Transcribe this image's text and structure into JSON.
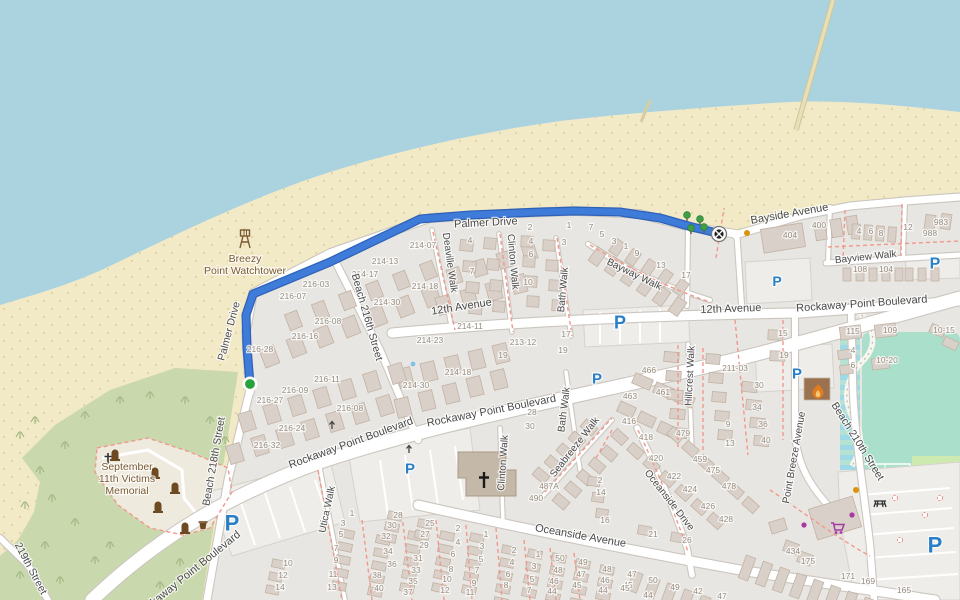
{
  "map": {
    "colors": {
      "water": "#aad3df",
      "sand": "#f2e9c6",
      "sand_speckle": "#dbcd99",
      "land": "#e8e6e2",
      "lot": "#efedea",
      "scrub": "#c9d8ad",
      "scrub_mark": "#a3b883",
      "memorial_ground": "#efeade",
      "grass": "#cdebb0",
      "pitch": "#aae0cb",
      "building": "#d9d0c9",
      "building_stroke": "#c2b3a3",
      "church": "#c4b8a8",
      "fire_building": "#9b7250",
      "road": "#ffffff",
      "road_casing": "#cbc6bf",
      "route": "#3f7bd9",
      "route_casing": "#2d62b8",
      "start_marker": "#28a33c",
      "parking_blue": "#2a7fc9",
      "street_label": "#4a4a4a",
      "house_number": "#978d7f",
      "poi_brown": "#7a5b33",
      "dashed_pink": "#f2988c",
      "tree_green": "#3f9e46",
      "shop_purple": "#a639a6",
      "flame_orange": "#e07b1f"
    },
    "route": {
      "points": [
        [
          250,
          384
        ],
        [
          247,
          348
        ],
        [
          246,
          315
        ],
        [
          253,
          294
        ],
        [
          330,
          262
        ],
        [
          420,
          219
        ],
        [
          470,
          215
        ],
        [
          540,
          212
        ],
        [
          575,
          211
        ],
        [
          620,
          212
        ],
        [
          660,
          218
        ],
        [
          692,
          227
        ],
        [
          717,
          233
        ]
      ]
    },
    "markers": {
      "start": {
        "x": 250,
        "y": 384
      },
      "end": {
        "x": 719,
        "y": 234
      }
    },
    "poi_labels": [
      {
        "name": "breezy-point-watchtower",
        "lines": [
          "Breezy",
          "Point Watchtower"
        ],
        "x": 245,
        "y": 262
      },
      {
        "name": "september-11th-victims-memorial",
        "lines": [
          "September",
          "11th Victims",
          "Memorial"
        ],
        "x": 127,
        "y": 470
      }
    ],
    "street_labels": [
      {
        "text": "Palmer Drive",
        "x": 232,
        "y": 332,
        "rot": -75,
        "size": 10.5
      },
      {
        "text": "Palmer Drive",
        "x": 486,
        "y": 226,
        "rot": -3,
        "size": 11
      },
      {
        "text": "Deaville Walk",
        "x": 447,
        "y": 263,
        "rot": 82,
        "size": 10
      },
      {
        "text": "Clinton Walk",
        "x": 510,
        "y": 262,
        "rot": 85,
        "size": 10
      },
      {
        "text": "Bath Walk",
        "x": 566,
        "y": 290,
        "rot": -85,
        "size": 10
      },
      {
        "text": "Bayway Walk",
        "x": 633,
        "y": 277,
        "rot": 26,
        "size": 10
      },
      {
        "text": "Bayside Avenue",
        "x": 790,
        "y": 217,
        "rot": -10,
        "size": 11
      },
      {
        "text": "Bayview Walk",
        "x": 866,
        "y": 260,
        "rot": -6,
        "size": 10
      },
      {
        "text": "12th Avenue",
        "x": 462,
        "y": 310,
        "rot": -9,
        "size": 11
      },
      {
        "text": "12th Avenue",
        "x": 731,
        "y": 312,
        "rot": -2,
        "size": 11
      },
      {
        "text": "Rockaway Point Boulevard",
        "x": 352,
        "y": 446,
        "rot": -20,
        "size": 11
      },
      {
        "text": "Rockaway Point Boulevard",
        "x": 492,
        "y": 414,
        "rot": -11,
        "size": 11
      },
      {
        "text": "Rockaway Point Boulevard",
        "x": 862,
        "y": 307,
        "rot": -4,
        "size": 11
      },
      {
        "text": "Rockaway Point Boulevard",
        "x": 190,
        "y": 577,
        "rot": -39,
        "size": 11
      },
      {
        "text": "Beach 218th Street",
        "x": 217,
        "y": 462,
        "rot": -80,
        "size": 10.5
      },
      {
        "text": "Beach 216th Street",
        "x": 364,
        "y": 318,
        "rot": 74,
        "size": 10.5
      },
      {
        "text": "219th Street",
        "x": 28,
        "y": 570,
        "rot": 62,
        "size": 10.5
      },
      {
        "text": "Utica Walk",
        "x": 330,
        "y": 510,
        "rot": -78,
        "size": 10
      },
      {
        "text": "Clinton Walk",
        "x": 506,
        "y": 463,
        "rot": -86,
        "size": 10
      },
      {
        "text": "Bath Walk",
        "x": 567,
        "y": 410,
        "rot": -83,
        "size": 10
      },
      {
        "text": "Seabreeze Walk",
        "x": 577,
        "y": 449,
        "rot": -52,
        "size": 10
      },
      {
        "text": "Oceanside Drive",
        "x": 667,
        "y": 502,
        "rot": 52,
        "size": 10
      },
      {
        "text": "Oceanside Avenue",
        "x": 580,
        "y": 539,
        "rot": 10,
        "size": 11
      },
      {
        "text": "Hillcrest Walk",
        "x": 693,
        "y": 376,
        "rot": -87,
        "size": 10
      },
      {
        "text": "Point Breeze Avenue",
        "x": 797,
        "y": 458,
        "rot": -80,
        "size": 10
      },
      {
        "text": "Beach 210th Street",
        "x": 855,
        "y": 443,
        "rot": 58,
        "size": 10.5
      }
    ],
    "house_numbers": [
      [
        423,
        248,
        "214-07"
      ],
      [
        385,
        264,
        "214-13"
      ],
      [
        365,
        277,
        "214-17"
      ],
      [
        316,
        287,
        "216-03"
      ],
      [
        293,
        299,
        "216-07"
      ],
      [
        425,
        289,
        "214-18"
      ],
      [
        387,
        305,
        "214-30"
      ],
      [
        328,
        324,
        "216-08"
      ],
      [
        305,
        339,
        "216-16"
      ],
      [
        260,
        352,
        "216-28"
      ],
      [
        470,
        329,
        "214-11"
      ],
      [
        430,
        343,
        "214-23"
      ],
      [
        523,
        345,
        "213-12"
      ],
      [
        503,
        358,
        "19"
      ],
      [
        458,
        375,
        "214-18"
      ],
      [
        416,
        388,
        "214-30"
      ],
      [
        327,
        382,
        "216-11"
      ],
      [
        295,
        393,
        "216-09"
      ],
      [
        270,
        403,
        "216-27"
      ],
      [
        350,
        411,
        "216-08"
      ],
      [
        292,
        431,
        "216-24"
      ],
      [
        267,
        448,
        "216-32"
      ],
      [
        470,
        243,
        "4"
      ],
      [
        472,
        274,
        "7"
      ],
      [
        530,
        230,
        "2"
      ],
      [
        531,
        244,
        "4"
      ],
      [
        531,
        257,
        "6"
      ],
      [
        528,
        285,
        "10"
      ],
      [
        569,
        228,
        "1"
      ],
      [
        564,
        245,
        "3"
      ],
      [
        591,
        230,
        "7"
      ],
      [
        602,
        237,
        "5"
      ],
      [
        614,
        244,
        "3"
      ],
      [
        626,
        249,
        "1"
      ],
      [
        637,
        256,
        "9"
      ],
      [
        661,
        268,
        "13"
      ],
      [
        686,
        278,
        "17"
      ],
      [
        566,
        337,
        "17"
      ],
      [
        563,
        353,
        "19"
      ],
      [
        783,
        336,
        "15"
      ],
      [
        784,
        358,
        "19"
      ],
      [
        759,
        388,
        "30"
      ],
      [
        757,
        410,
        "34"
      ],
      [
        763,
        427,
        "36"
      ],
      [
        766,
        443,
        "40"
      ],
      [
        728,
        427,
        "9"
      ],
      [
        730,
        446,
        "13"
      ],
      [
        790,
        238,
        "404"
      ],
      [
        819,
        228,
        "400"
      ],
      [
        859,
        234,
        "4"
      ],
      [
        871,
        234,
        "6"
      ],
      [
        881,
        236,
        "8"
      ],
      [
        908,
        230,
        "12"
      ],
      [
        941,
        225,
        "983"
      ],
      [
        930,
        236,
        "988"
      ],
      [
        860,
        272,
        "108"
      ],
      [
        886,
        272,
        "104"
      ],
      [
        649,
        373,
        "466"
      ],
      [
        630,
        399,
        "463"
      ],
      [
        663,
        395,
        "461"
      ],
      [
        629,
        424,
        "416"
      ],
      [
        646,
        440,
        "418"
      ],
      [
        683,
        436,
        "479"
      ],
      [
        735,
        371,
        "211-03"
      ],
      [
        853,
        334,
        "115"
      ],
      [
        890,
        333,
        "109"
      ],
      [
        944,
        333,
        "10-15"
      ],
      [
        853,
        353,
        "4"
      ],
      [
        853,
        368,
        "6"
      ],
      [
        887,
        363,
        "10-20"
      ],
      [
        656,
        461,
        "420"
      ],
      [
        674,
        479,
        "422"
      ],
      [
        690,
        492,
        "424"
      ],
      [
        708,
        509,
        "426"
      ],
      [
        726,
        522,
        "428"
      ],
      [
        700,
        462,
        "459"
      ],
      [
        713,
        473,
        "475"
      ],
      [
        729,
        489,
        "478"
      ],
      [
        549,
        489,
        "487A"
      ],
      [
        536,
        501,
        "490"
      ],
      [
        600,
        483,
        "2"
      ],
      [
        601,
        495,
        "14"
      ],
      [
        605,
        523,
        "16"
      ],
      [
        653,
        537,
        "21"
      ],
      [
        687,
        543,
        "26"
      ],
      [
        530,
        429,
        "30"
      ],
      [
        532,
        415,
        "28"
      ],
      [
        352,
        516,
        "1"
      ],
      [
        343,
        526,
        "3"
      ],
      [
        341,
        537,
        "5"
      ],
      [
        336,
        551,
        "7"
      ],
      [
        336,
        563,
        "9"
      ],
      [
        333,
        577,
        "11"
      ],
      [
        332,
        590,
        "13"
      ],
      [
        398,
        518,
        "28"
      ],
      [
        392,
        528,
        "30"
      ],
      [
        386,
        539,
        "32"
      ],
      [
        388,
        554,
        "34"
      ],
      [
        392,
        567,
        "36"
      ],
      [
        377,
        578,
        "38"
      ],
      [
        379,
        591,
        "40"
      ],
      [
        430,
        526,
        "25"
      ],
      [
        425,
        537,
        "27"
      ],
      [
        424,
        548,
        "29"
      ],
      [
        418,
        561,
        "31"
      ],
      [
        416,
        573,
        "33"
      ],
      [
        413,
        584,
        "35"
      ],
      [
        408,
        595,
        "37"
      ],
      [
        458,
        531,
        "2"
      ],
      [
        458,
        545,
        "4"
      ],
      [
        453,
        557,
        "6"
      ],
      [
        451,
        572,
        "8"
      ],
      [
        447,
        582,
        "10"
      ],
      [
        445,
        593,
        "12"
      ],
      [
        486,
        537,
        "1"
      ],
      [
        482,
        549,
        "3"
      ],
      [
        481,
        562,
        "5"
      ],
      [
        477,
        573,
        "7"
      ],
      [
        474,
        586,
        "9"
      ],
      [
        470,
        595,
        "11"
      ],
      [
        514,
        553,
        "2"
      ],
      [
        512,
        565,
        "4"
      ],
      [
        508,
        577,
        "6"
      ],
      [
        506,
        588,
        "8"
      ],
      [
        538,
        557,
        "1"
      ],
      [
        534,
        569,
        "3"
      ],
      [
        532,
        582,
        "5"
      ],
      [
        529,
        593,
        "7"
      ],
      [
        560,
        561,
        "50"
      ],
      [
        558,
        573,
        "48"
      ],
      [
        554,
        584,
        "46"
      ],
      [
        552,
        594,
        "44"
      ],
      [
        583,
        565,
        "49"
      ],
      [
        581,
        577,
        "47"
      ],
      [
        577,
        588,
        "45"
      ],
      [
        607,
        572,
        "48"
      ],
      [
        605,
        583,
        "46"
      ],
      [
        603,
        593,
        "44"
      ],
      [
        628,
        588,
        "45"
      ],
      [
        288,
        566,
        "10"
      ],
      [
        283,
        578,
        "12"
      ],
      [
        280,
        590,
        "14"
      ],
      [
        632,
        577,
        "47"
      ],
      [
        625,
        591,
        "45"
      ],
      [
        653,
        583,
        "50"
      ],
      [
        648,
        598,
        "44"
      ],
      [
        675,
        590,
        "49"
      ],
      [
        698,
        594,
        "42"
      ],
      [
        722,
        599,
        "47"
      ],
      [
        793,
        554,
        "434"
      ],
      [
        808,
        564,
        "175"
      ],
      [
        848,
        579,
        "171"
      ],
      [
        868,
        584,
        "169"
      ],
      [
        904,
        593,
        "165"
      ]
    ],
    "parking_icons": [
      {
        "x": 620,
        "y": 322,
        "s": 18
      },
      {
        "x": 597,
        "y": 378,
        "s": 15
      },
      {
        "x": 410,
        "y": 468,
        "s": 15
      },
      {
        "x": 232,
        "y": 523,
        "s": 22
      },
      {
        "x": 777,
        "y": 281,
        "s": 14
      },
      {
        "x": 935,
        "y": 263,
        "s": 16
      },
      {
        "x": 797,
        "y": 373,
        "s": 15
      },
      {
        "x": 935,
        "y": 545,
        "s": 22
      }
    ],
    "icons": [
      {
        "type": "watchtower",
        "x": 245,
        "y": 239
      },
      {
        "type": "memorial-cross",
        "x": 108,
        "y": 459
      },
      {
        "type": "memorial",
        "x": 115,
        "y": 455
      },
      {
        "type": "memorial",
        "x": 155,
        "y": 473
      },
      {
        "type": "memorial",
        "x": 175,
        "y": 488
      },
      {
        "type": "memorial",
        "x": 158,
        "y": 507
      },
      {
        "type": "memorial",
        "x": 185,
        "y": 528
      },
      {
        "type": "waste-basket",
        "x": 203,
        "y": 525
      },
      {
        "type": "picnic-table",
        "x": 880,
        "y": 503
      },
      {
        "type": "supermarket-cart",
        "x": 838,
        "y": 528
      },
      {
        "type": "shop-dot",
        "x": 852,
        "y": 515
      },
      {
        "type": "shop-dot",
        "x": 804,
        "y": 525
      },
      {
        "type": "poi-dot-orange",
        "x": 856,
        "y": 490
      },
      {
        "type": "poi-dot-orange",
        "x": 747,
        "y": 233
      },
      {
        "type": "fire-flame",
        "x": 818,
        "y": 391
      },
      {
        "type": "church-cross",
        "x": 484,
        "y": 481
      },
      {
        "type": "tree",
        "x": 687,
        "y": 216
      },
      {
        "type": "tree",
        "x": 700,
        "y": 220
      },
      {
        "type": "tree",
        "x": 691,
        "y": 229
      },
      {
        "type": "tree",
        "x": 704,
        "y": 228
      },
      {
        "type": "water-dot",
        "x": 413,
        "y": 364
      },
      {
        "type": "oneway-arrow",
        "x": 332,
        "y": 425
      },
      {
        "type": "oneway-arrow",
        "x": 409,
        "y": 449
      }
    ]
  }
}
